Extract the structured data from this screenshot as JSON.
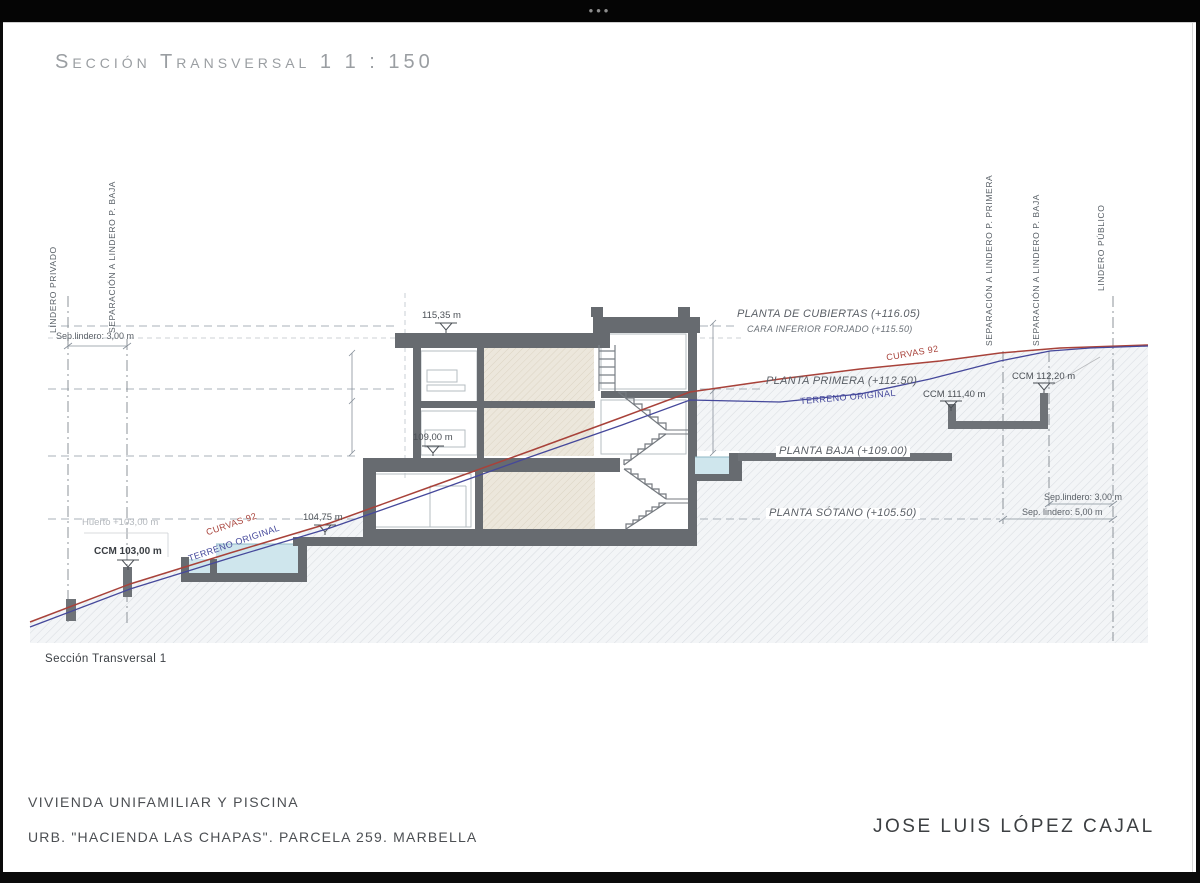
{
  "window": {
    "menu_dots": "•••"
  },
  "title": "Sección Transversal 1 1 : 150",
  "caption": "Sección Transversal 1",
  "footer": {
    "line1": "VIVIENDA UNIFAMILIAR Y PISCINA",
    "line2": "URB. \"HACIENDA LAS CHAPAS\". PARCELA 259. MARBELLA",
    "architect": "JOSE LUIS LÓPEZ CAJAL"
  },
  "boundaries": {
    "left_private": "LINDERO PRIVADO",
    "left_sep_baja": "SEPARACIÓN A LINDERO P. BAJA",
    "right_sep_primera": "SEPARACIÓN A LINDERO P. PRIMERA",
    "right_sep_baja": "SEPARACIÓN A LINDERO P. BAJA",
    "right_public": "LINDERO PÚBLICO",
    "sep_left": "Sep.lindero: 3,00 m",
    "sep_right_3": "Sep.lindero: 3,00 m",
    "sep_right_5": "Sep. lindero: 5,00 m"
  },
  "levels": {
    "cubiertas": "PLANTA DE CUBIERTAS (+116.05)",
    "forjado": "CARA INFERIOR FORJADO (+115.50)",
    "primera": "PLANTA PRIMERA (+112.50)",
    "baja": "PLANTA BAJA (+109.00)",
    "sotano": "PLANTA SÓTANO (+105.50)"
  },
  "elevations": {
    "roof": "115,35 m",
    "ground": "109,00 m",
    "pool_deck": "104,75 m",
    "ccm_103": "CCM 103,00 m",
    "huerto": "Huerto +103,00 m",
    "ccm_111": "CCM 111,40 m",
    "ccm_112": "CCM 112,20 m"
  },
  "terrain": {
    "curvas_left": "CURVAS 92",
    "curvas_right": "CURVAS 92",
    "original_left": "TERRENO ORIGINAL",
    "original_right": "TERRENO ORIGINAL"
  },
  "colors": {
    "curvas_line": "#a8423a",
    "terreno_line": "#45489b",
    "structure_gray": "#676b70",
    "pool_water": "#cfe6ed"
  }
}
